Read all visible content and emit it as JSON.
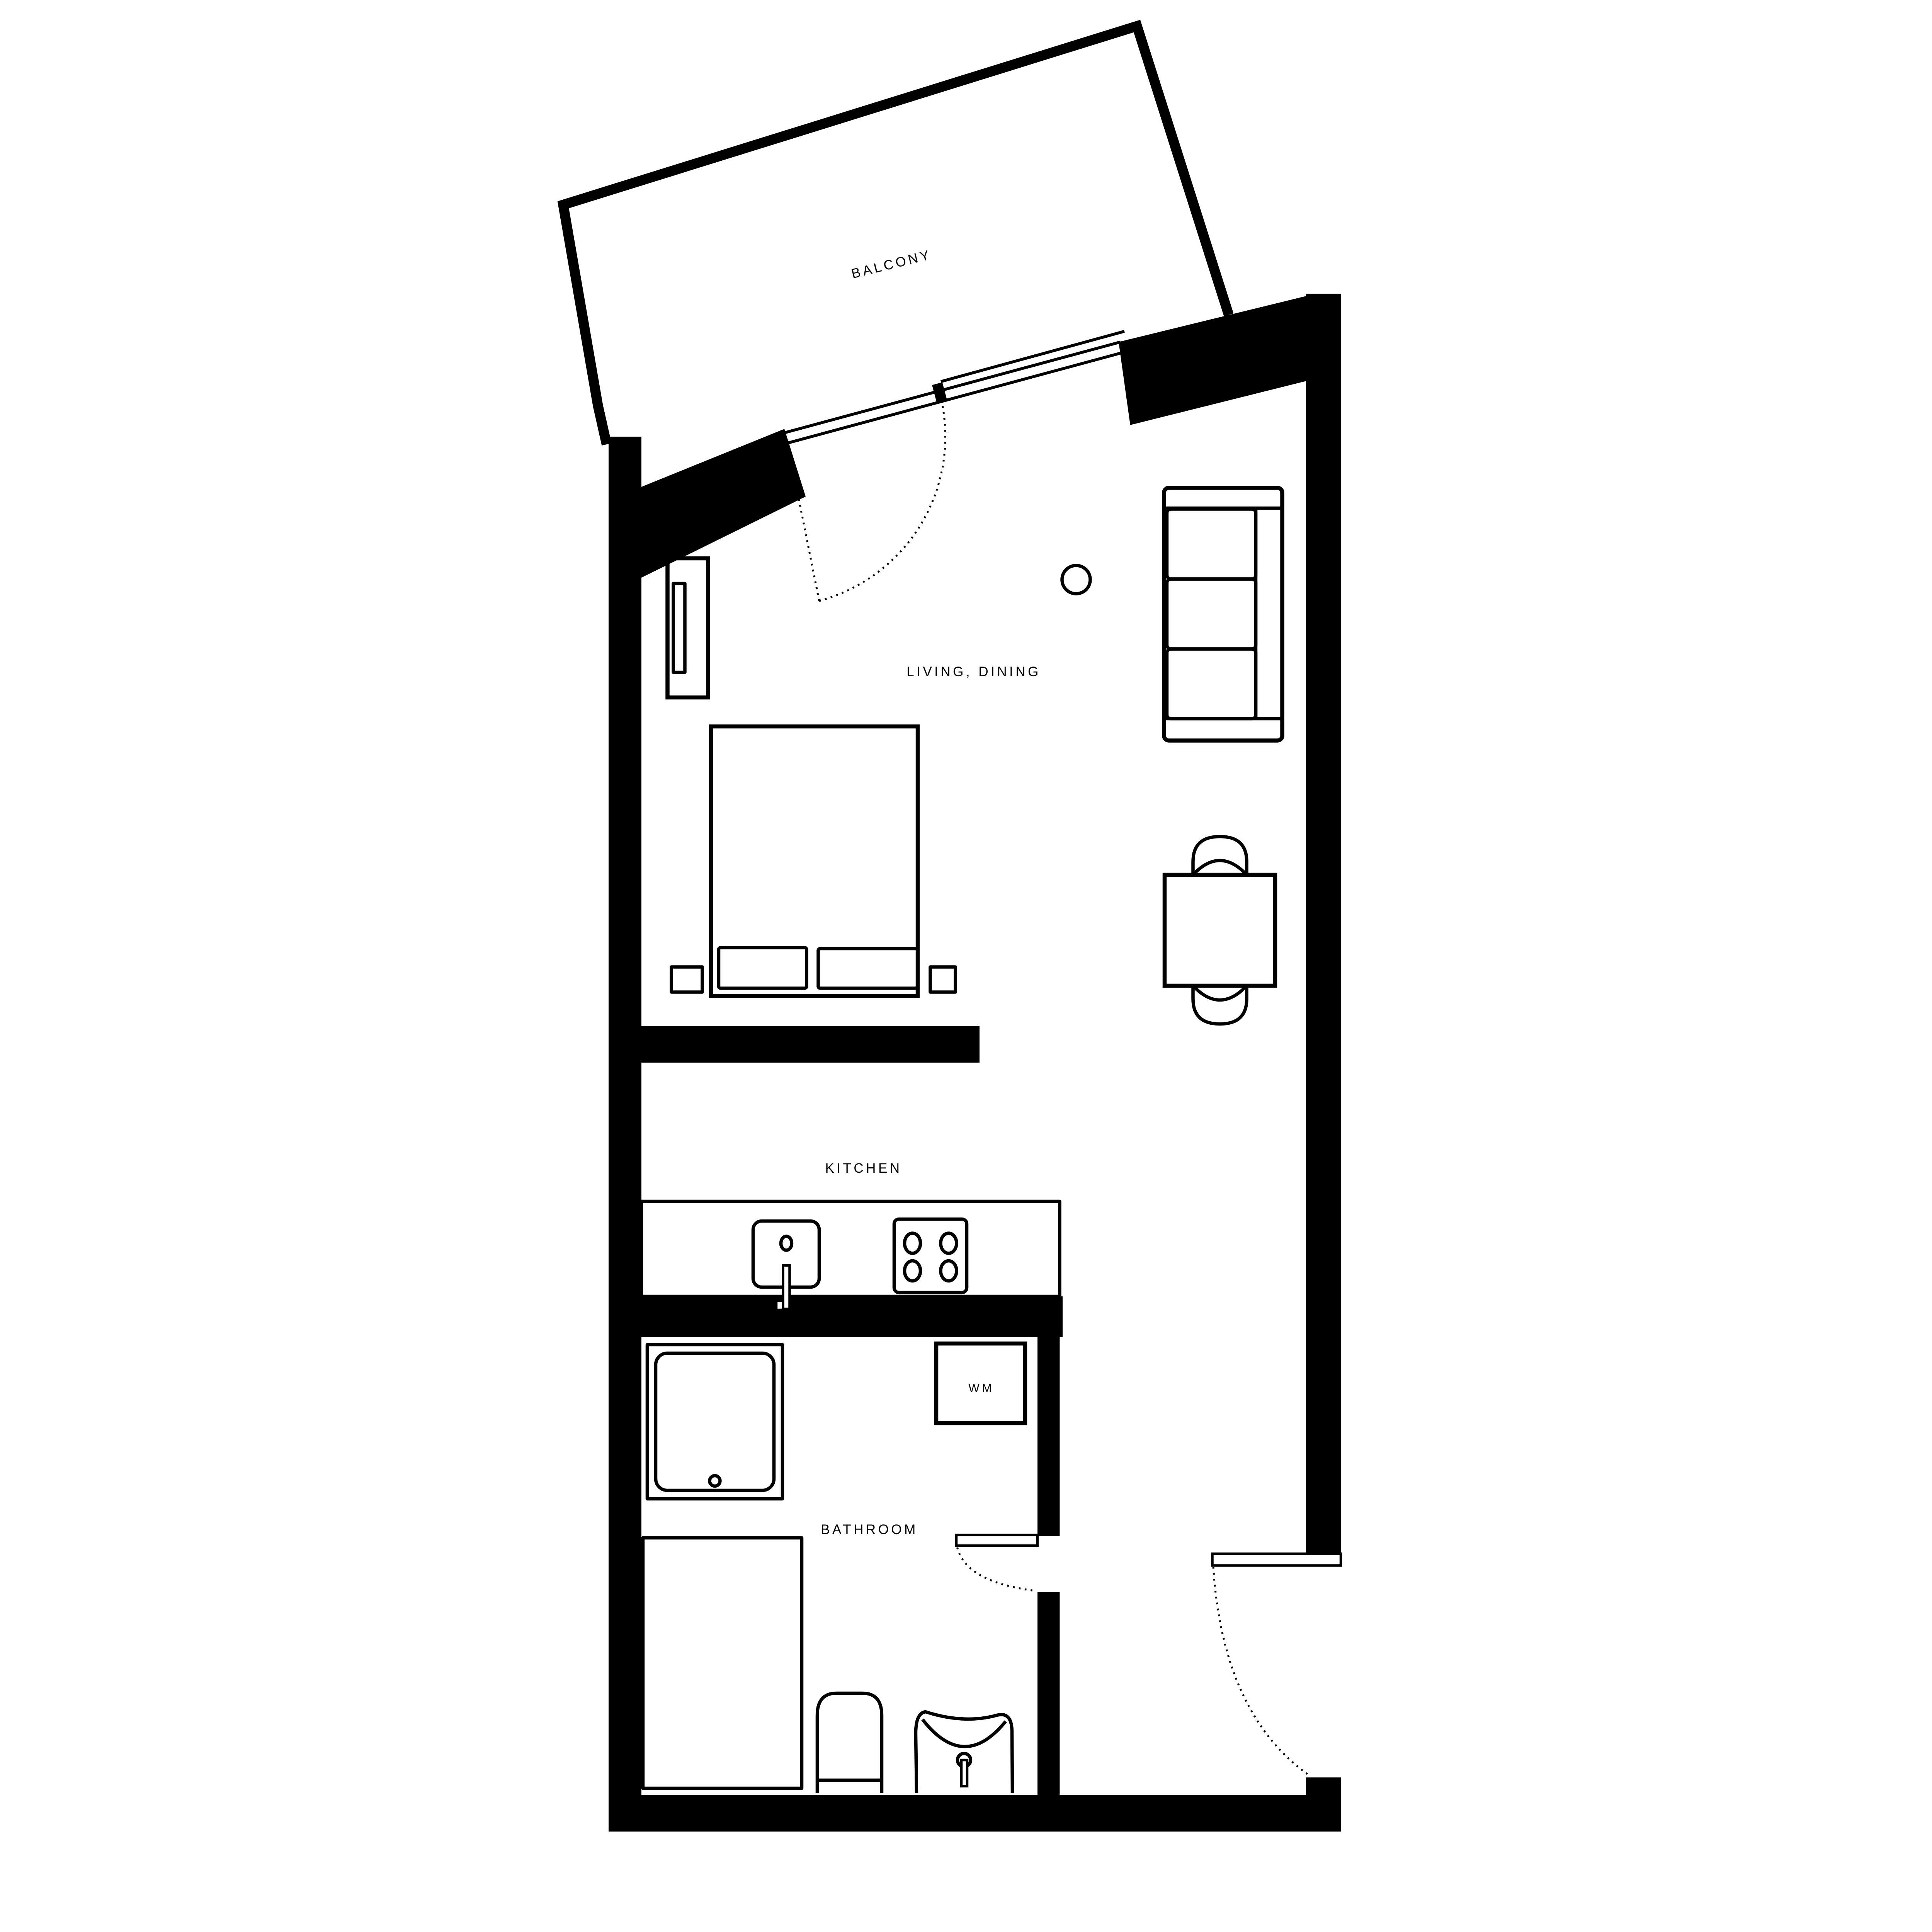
{
  "plan": {
    "title": "studio apartment floor plan",
    "labels": {
      "balcony": "BALCONY",
      "living_dining": "LIVING, DINING",
      "kitchen": "KITCHEN",
      "bathroom": "BATHROOM",
      "washing_machine": "WM"
    },
    "rooms": [
      {
        "id": "balcony",
        "label": "BALCONY"
      },
      {
        "id": "living-dining",
        "label": "LIVING, DINING"
      },
      {
        "id": "kitchen",
        "label": "KITCHEN"
      },
      {
        "id": "bathroom",
        "label": "BATHROOM"
      }
    ],
    "colors": {
      "walls": "#000000",
      "background": "#ffffff",
      "lines": "#000000"
    }
  }
}
